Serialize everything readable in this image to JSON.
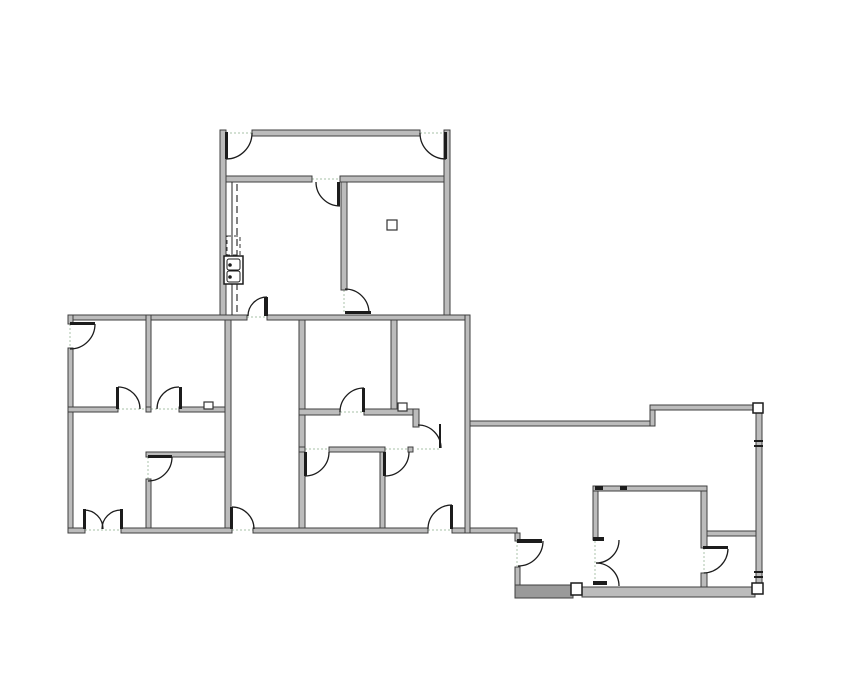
{
  "meta": {
    "app_title": "floor-plan-viewer",
    "description": "Black and gray 2D architectural floor plan line drawing on a white background; three joined building sections with interior rooms, swing doors, a corridor, a sink fixture and corner columns. No visible text labels."
  },
  "palette": {
    "background": "#ffffff",
    "wall_fill": "#bcbcbc",
    "wall_edge": "#3f3f3f",
    "hatch_fill": "#9a9a9a",
    "ink": "#1c1c1c",
    "threshold": "#b9cdb9",
    "dash": "#333333"
  },
  "floorplan": {
    "canvas": {
      "w": 855,
      "h": 678
    },
    "walls": [
      [
        220,
        130,
        6,
        189
      ],
      [
        444,
        130,
        6,
        189
      ],
      [
        252,
        130,
        168,
        6
      ],
      [
        226,
        176,
        86,
        6
      ],
      [
        340,
        176,
        104,
        6
      ],
      [
        341,
        182,
        6,
        108
      ],
      [
        68,
        315,
        179,
        5
      ],
      [
        267,
        315,
        203,
        5
      ],
      [
        68,
        315,
        5,
        9
      ],
      [
        68,
        348,
        5,
        185
      ],
      [
        146,
        315,
        5,
        92
      ],
      [
        68,
        407,
        50,
        5
      ],
      [
        146,
        407,
        5,
        5
      ],
      [
        179,
        407,
        46,
        5
      ],
      [
        146,
        452,
        85,
        5
      ],
      [
        146,
        479,
        5,
        54
      ],
      [
        225,
        320,
        6,
        208
      ],
      [
        299,
        320,
        6,
        208
      ],
      [
        68,
        528,
        17,
        5
      ],
      [
        121,
        528,
        111,
        5
      ],
      [
        253,
        528,
        175,
        5
      ],
      [
        452,
        528,
        65,
        5
      ],
      [
        391,
        320,
        6,
        90
      ],
      [
        299,
        409,
        41,
        6
      ],
      [
        364,
        409,
        55,
        6
      ],
      [
        413,
        409,
        6,
        18
      ],
      [
        299,
        447,
        6,
        5
      ],
      [
        329,
        447,
        56,
        5
      ],
      [
        408,
        447,
        5,
        5
      ],
      [
        380,
        452,
        5,
        76
      ],
      [
        465,
        315,
        5,
        218
      ],
      [
        470,
        421,
        183,
        5
      ],
      [
        650,
        405,
        5,
        21
      ],
      [
        650,
        405,
        107,
        5
      ],
      [
        756,
        410,
        6,
        178
      ],
      [
        515,
        533,
        5,
        8
      ],
      [
        515,
        567,
        5,
        20
      ],
      [
        593,
        487,
        5,
        53
      ],
      [
        593,
        486,
        114,
        5
      ],
      [
        701,
        491,
        6,
        57
      ],
      [
        701,
        573,
        6,
        17
      ],
      [
        707,
        531,
        49,
        5
      ],
      [
        582,
        587,
        173,
        10
      ]
    ],
    "hatch_walls": [
      [
        515,
        585,
        58,
        13
      ]
    ],
    "columns": [
      [
        753,
        403,
        10,
        10
      ],
      [
        571,
        583,
        11,
        12
      ],
      [
        752,
        583,
        11,
        11
      ]
    ],
    "squares": [
      [
        387,
        220,
        10,
        10
      ],
      [
        398,
        403,
        9,
        8
      ],
      [
        204,
        402,
        9,
        7
      ]
    ],
    "black_marks": [
      [
        593,
        537,
        11,
        4
      ],
      [
        593,
        581,
        14,
        4
      ],
      [
        595,
        486,
        8,
        4
      ],
      [
        620,
        486,
        7,
        4
      ],
      [
        754,
        440,
        9,
        2
      ],
      [
        754,
        445,
        9,
        2
      ],
      [
        754,
        571,
        9,
        2
      ],
      [
        754,
        576,
        9,
        2
      ]
    ],
    "door_leaves": [
      [
        225,
        132,
        3,
        27
      ],
      [
        444,
        132,
        3,
        27
      ],
      [
        337,
        182,
        3,
        24
      ],
      [
        345,
        311,
        26,
        3
      ],
      [
        264,
        297,
        4,
        19
      ],
      [
        70,
        322,
        25,
        3
      ],
      [
        116,
        387,
        3,
        22
      ],
      [
        179,
        387,
        3,
        22
      ],
      [
        148,
        455,
        24,
        3
      ],
      [
        83,
        509,
        3,
        20
      ],
      [
        120,
        509,
        3,
        20
      ],
      [
        230,
        507,
        3,
        22
      ],
      [
        450,
        505,
        3,
        24
      ],
      [
        362,
        388,
        3,
        24
      ],
      [
        304,
        452,
        3,
        24
      ],
      [
        383,
        452,
        3,
        24
      ],
      [
        439,
        424,
        2,
        24
      ],
      [
        517,
        539,
        25,
        4
      ],
      [
        703,
        546,
        25,
        3
      ]
    ],
    "door_arcs": [
      "M226,159 A26,26 0 0 0 252,133",
      "M446,159 A26,26 0 0 1 420,133",
      "M316,182 A24,24 0 0 0 340,206",
      "M345,289 A24,24 0 0 1 369,313",
      "M248,316 A19,19 0 0 1 267,297",
      "M95,324 A25,25 0 0 1 70,349",
      "M118,387 A22,22 0 0 1 140,409",
      "M157,409 A22,22 0 0 1 179,387",
      "M172,457 A24,24 0 0 1 148,481",
      "M84,510 A19,19 0 0 1 103,529",
      "M121,510 A19,19 0 0 0 102,529",
      "M232,507 A22,22 0 0 1 254,529",
      "M428,529 A24,24 0 0 1 452,505",
      "M340,412 A24,24 0 0 1 364,388",
      "M329,452 A24,24 0 0 1 305,476",
      "M385,476 A24,24 0 0 0 409,452",
      "M418,425 A23,23 0 0 1 441,448",
      "M543,541 A25,25 0 0 1 518,566",
      "M728,549 A25,25 0 0 1 704,573",
      "M619,540 A23,23 0 0 1 596,563",
      "M596,563 A23,23 0 0 1 619,586"
    ],
    "thresholds": [
      [
        226,
        133,
        252,
        133
      ],
      [
        420,
        133,
        446,
        133
      ],
      [
        312,
        179,
        340,
        179
      ],
      [
        344,
        290,
        344,
        313
      ],
      [
        247,
        317,
        267,
        317
      ],
      [
        70,
        324,
        70,
        348
      ],
      [
        118,
        409,
        146,
        409
      ],
      [
        151,
        409,
        179,
        409
      ],
      [
        148,
        457,
        148,
        479
      ],
      [
        85,
        530,
        121,
        530
      ],
      [
        232,
        530,
        253,
        530
      ],
      [
        428,
        530,
        452,
        530
      ],
      [
        340,
        412,
        364,
        412
      ],
      [
        305,
        449,
        329,
        449
      ],
      [
        385,
        449,
        409,
        449
      ],
      [
        417,
        449,
        441,
        449
      ],
      [
        517,
        541,
        517,
        566
      ],
      [
        595,
        541,
        595,
        585
      ],
      [
        704,
        548,
        704,
        573
      ]
    ],
    "lines": [
      [
        232,
        182,
        232,
        315
      ]
    ],
    "dashed_lines": [
      [
        237,
        184,
        237,
        312
      ]
    ],
    "dashed_rects": [
      [
        227,
        236,
        13,
        19
      ]
    ],
    "sink": {
      "outer": [
        224,
        256,
        19,
        28
      ],
      "bowls": [
        [
          227,
          259,
          13,
          11
        ],
        [
          227,
          271,
          13,
          11
        ]
      ],
      "dots": [
        [
          230,
          265
        ],
        [
          230,
          277
        ]
      ]
    }
  }
}
